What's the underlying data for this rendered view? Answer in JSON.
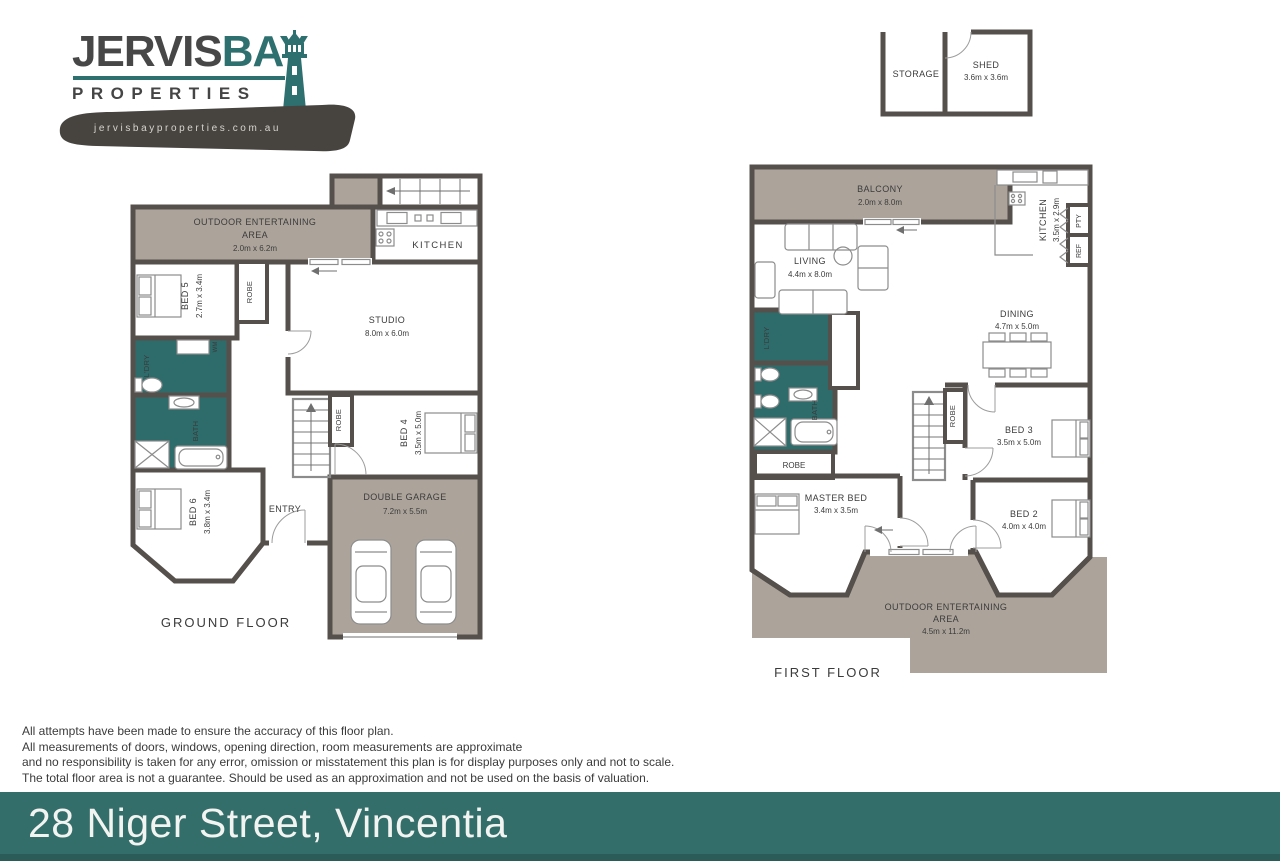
{
  "logo": {
    "brand_part1": "JERVIS",
    "brand_part2": "BAY",
    "brand_sub": "PROPERTIES",
    "website": "jervisbayproperties.com.au"
  },
  "outbuilding": {
    "storage": "STORAGE",
    "shed": "SHED",
    "shed_dims": "3.6m x 3.6m"
  },
  "ground_floor": {
    "title": "GROUND FLOOR",
    "oea_l1": "OUTDOOR ENTERTAINING",
    "oea_l2": "AREA",
    "oea_l3": "2.0m x 6.2m",
    "kitchen": "KITCHEN",
    "studio": "STUDIO",
    "studio_dims": "8.0m x 6.0m",
    "bed5": "BED 5",
    "bed5_dims": "2.7m x 3.4m",
    "robe1": "ROBE",
    "ldry": "L'DRY",
    "wm": "WM",
    "bath": "BATH",
    "bed6": "BED 6",
    "bed6_dims": "3.8m x 3.4m",
    "entry": "ENTRY",
    "robe2": "ROBE",
    "bed4": "BED 4",
    "bed4_dims": "3.5m x 5.0m",
    "garage": "DOUBLE GARAGE",
    "garage_dims": "7.2m x 5.5m"
  },
  "first_floor": {
    "title": "FIRST FLOOR",
    "balcony": "BALCONY",
    "balcony_dims": "2.0m x 8.0m",
    "kitchen": "KITCHEN",
    "kitchen_dims": "3.5m x 2.9m",
    "pty": "PTY",
    "ref": "REF",
    "living": "LIVING",
    "living_dims": "4.4m x 8.0m",
    "dining": "DINING",
    "dining_dims": "4.7m x 5.0m",
    "ldry": "L'DRY",
    "bath": "BATH",
    "robe1": "ROBE",
    "robe2": "ROBE",
    "master": "MASTER BED",
    "master_dims": "3.4m x 3.5m",
    "bed3": "BED 3",
    "bed3_dims": "3.5m x 5.0m",
    "bed2": "BED 2",
    "bed2_dims": "4.0m x 4.0m",
    "oea_l1": "OUTDOOR ENTERTAINING",
    "oea_l2": "AREA",
    "oea_l3": "4.5m x 11.2m"
  },
  "disclaimer": {
    "line1": "All attempts have been made to ensure the accuracy of this floor plan.",
    "line2": "All measurements of doors, windows, opening direction, room measurements are approximate",
    "line3": "and no responsibility is taken for any error, omission or misstatement this plan is for display purposes only and not to scale.",
    "line4": "The total floor area is not a guarantee. Should be used as an approximation and not be used on the basis of valuation."
  },
  "footer": {
    "address": "28 Niger Street, Vincentia"
  },
  "colors": {
    "teal_room": "#2e6b6b",
    "banner_teal": "#346e6a",
    "taupe_outdoor": "#aca49b",
    "wall": "#55504b",
    "brand_teal": "#2e6f6f",
    "brand_gray": "#474747"
  }
}
